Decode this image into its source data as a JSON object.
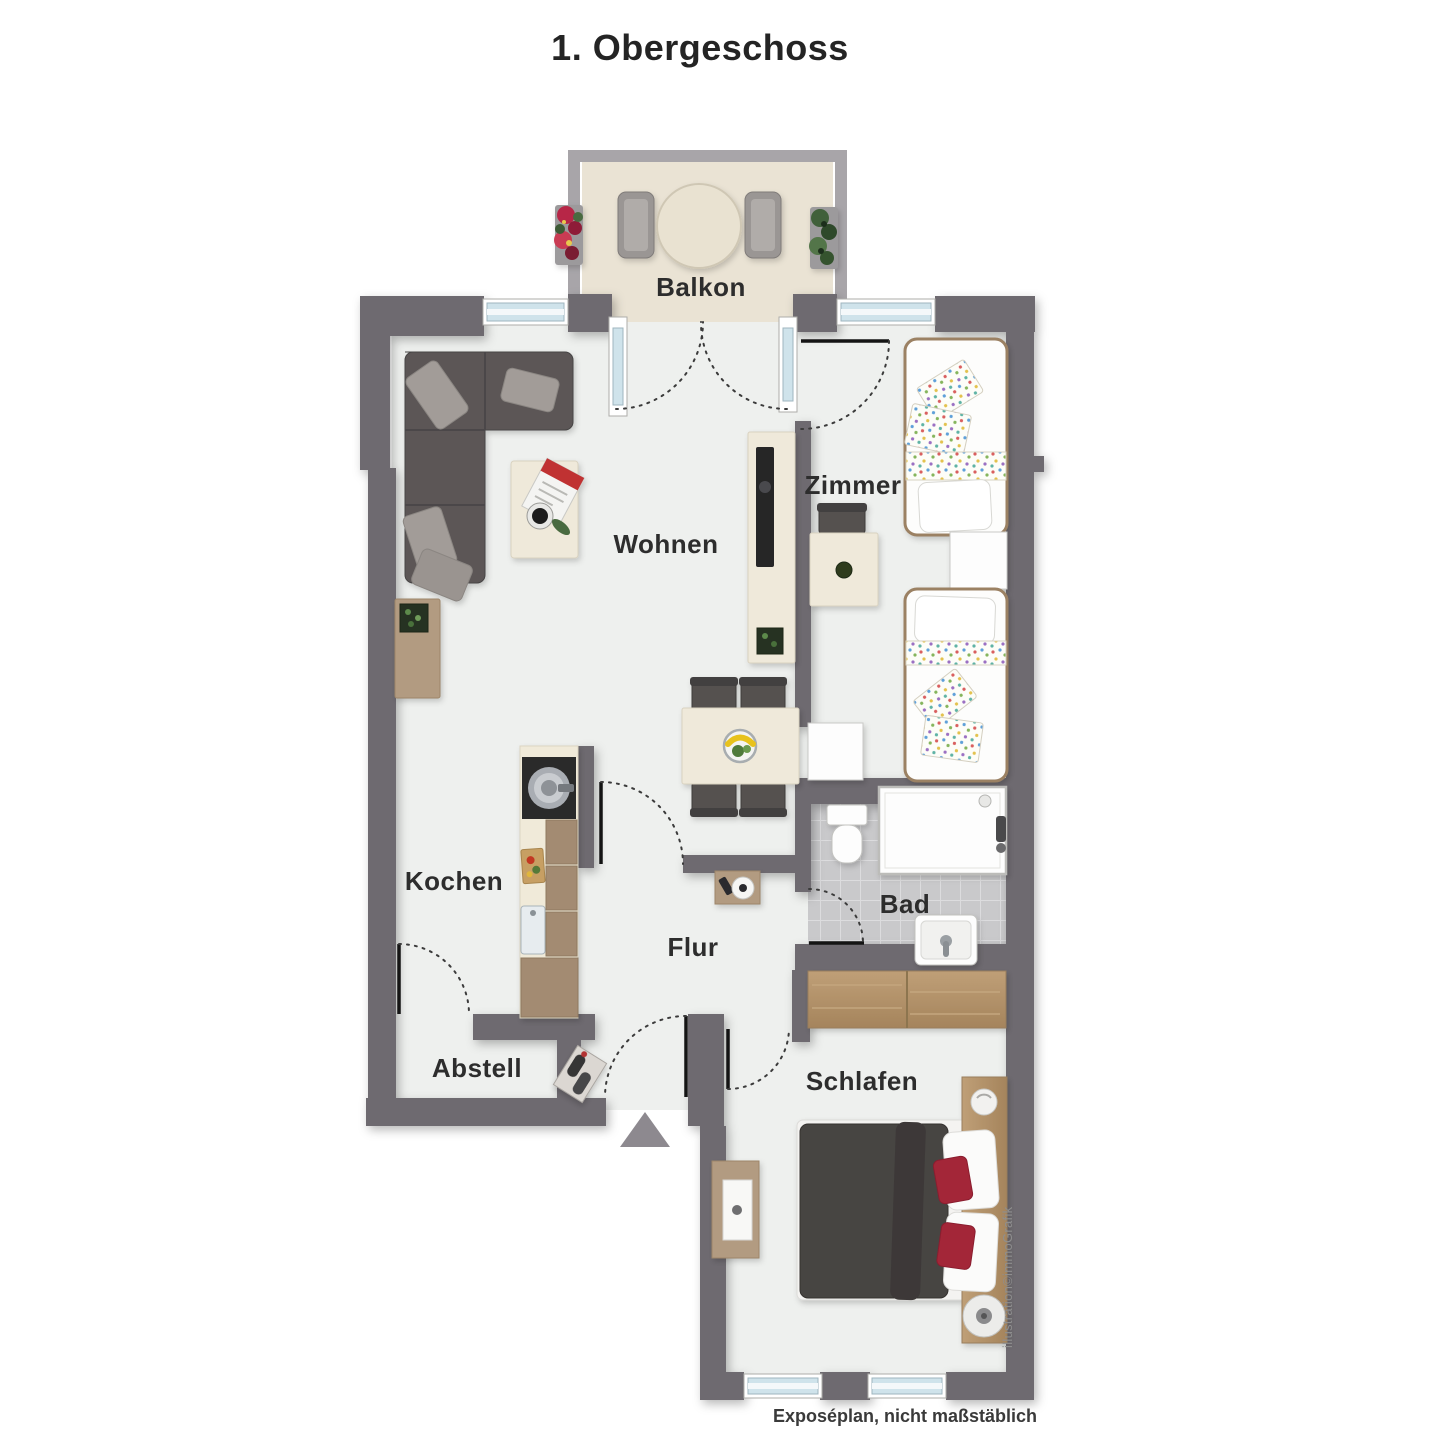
{
  "title": "1. Obergeschoss",
  "rooms": {
    "balkon": "Balkon",
    "wohnen": "Wohnen",
    "zimmer": "Zimmer",
    "kochen": "Kochen",
    "flur": "Flur",
    "bad": "Bad",
    "abstell": "Abstell",
    "schlafen": "Schlafen"
  },
  "caption": "Exposéplan, nicht maßstäblich",
  "watermark": "illustration©immoGrafik",
  "colors": {
    "wall": "#6e6a6f",
    "balcony_railing": "#a8a5a9",
    "floor": "#eef0ee",
    "balcony_floor": "#eae3d4",
    "bath_tile": "#c9c9cb",
    "window_blue": "#cfe3eb",
    "wood_light": "#efe9da",
    "wood_brown": "#b29b81",
    "cabinet_brown": "#a38b72",
    "sofa_gray": "#5b5757",
    "duvet_gray": "#474443",
    "chair_gray": "#55514f",
    "accent_red": "#a32638",
    "plant_green": "#3f5d38",
    "label_text": "#2d2d2d"
  }
}
